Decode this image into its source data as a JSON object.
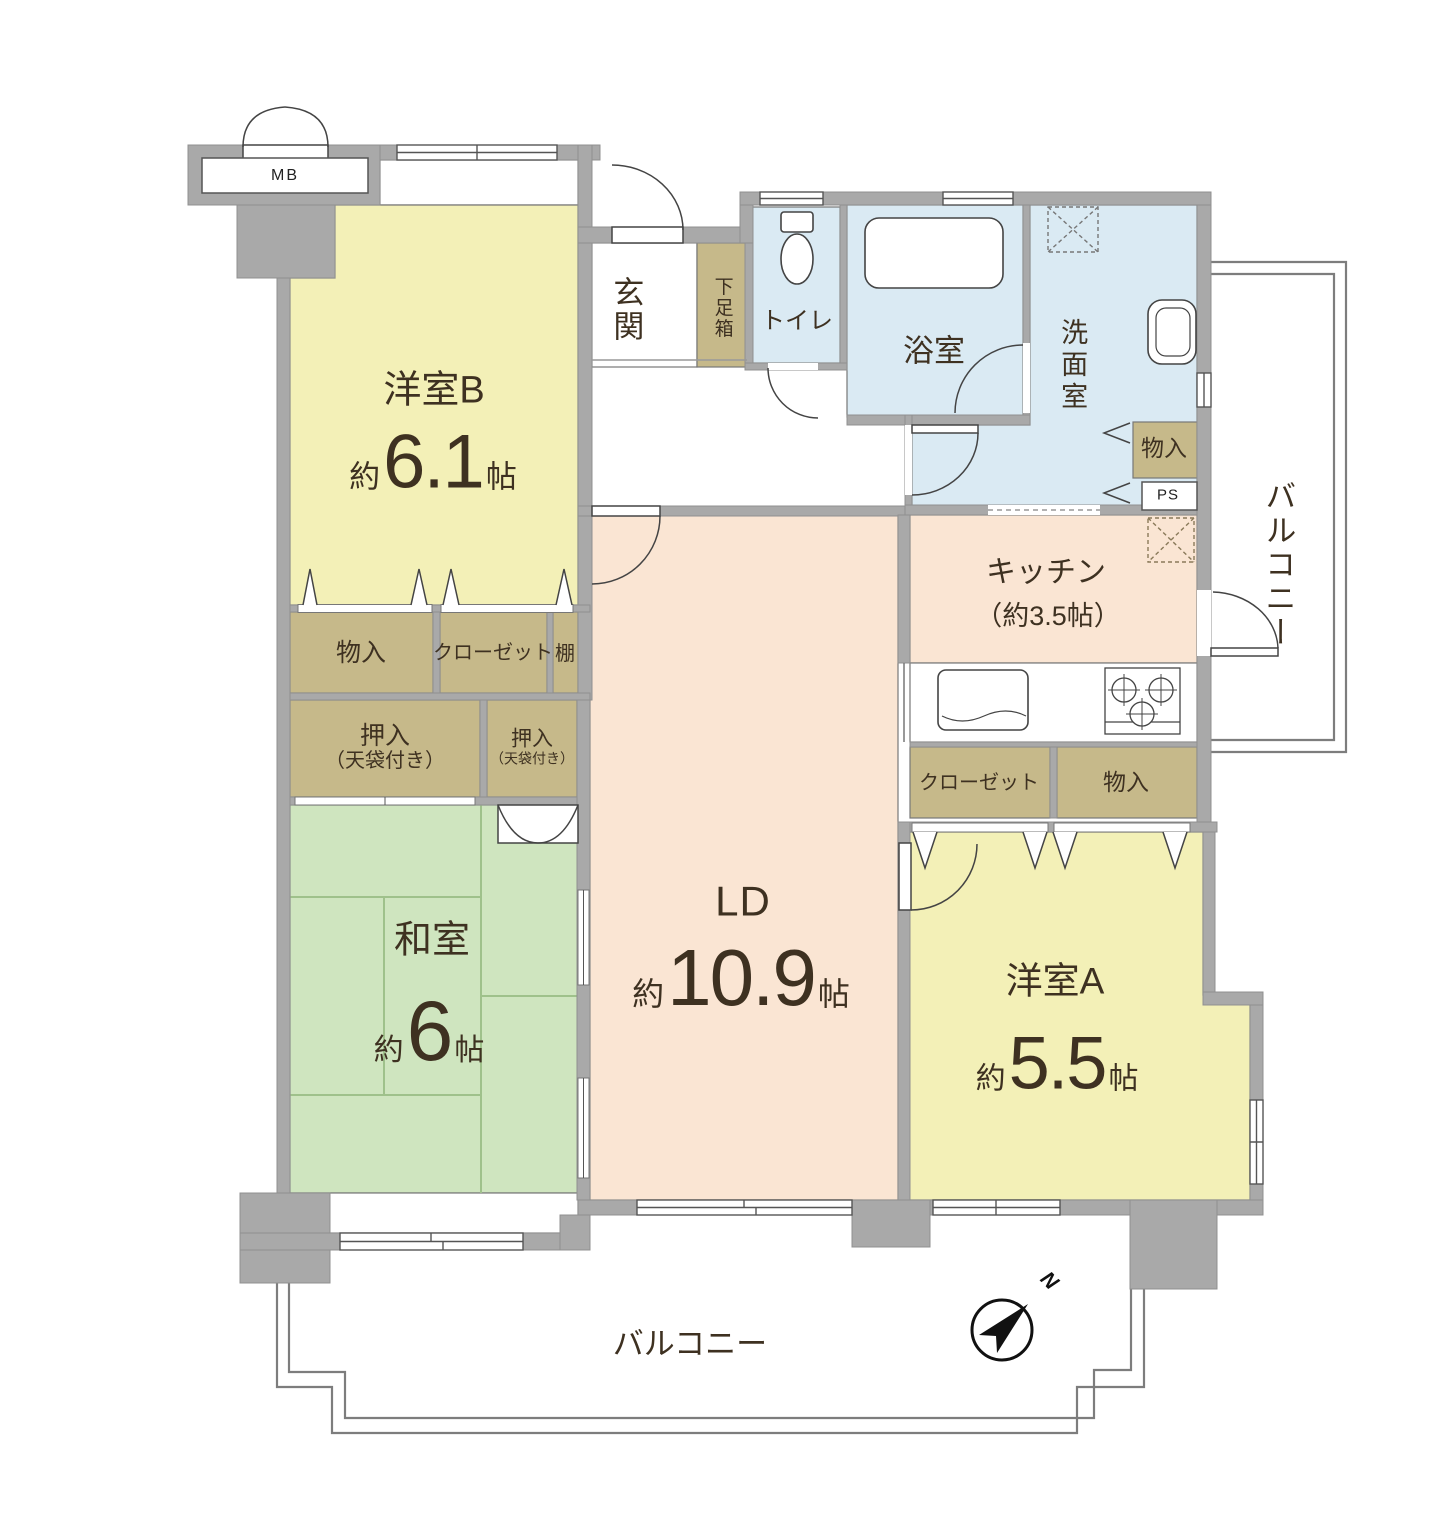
{
  "colors": {
    "wall": "#a9a9a9",
    "western_room": "#f3f0b7",
    "japanese_room": "#cfe5bf",
    "living_dining": "#fae5d3",
    "sanitary": "#daeaf3",
    "storage": "#c6b98a",
    "outline": "#555555",
    "label_text": "#3e3121"
  },
  "rooms": {
    "yoshitsu_b": {
      "name": "洋室B",
      "approx": "約",
      "value": "6.1",
      "unit": "帖"
    },
    "washitsu": {
      "name": "和室",
      "approx": "約",
      "value": "6",
      "unit": "帖"
    },
    "ld": {
      "name": "LD",
      "approx": "約",
      "value": "10.9",
      "unit": "帖"
    },
    "yoshitsu_a": {
      "name": "洋室A",
      "approx": "約",
      "value": "5.5",
      "unit": "帖"
    },
    "kitchen": {
      "name": "キッチン",
      "size_note": "（約3.5帖）"
    },
    "genkan": {
      "name": "玄関"
    },
    "getabako": {
      "name": "下足箱"
    },
    "toilet": {
      "name": "トイレ"
    },
    "bath": {
      "name": "浴室"
    },
    "senmenshitsu": {
      "name": "洗面室"
    }
  },
  "storage": {
    "monoire_washroom": "物入",
    "ps": "PS",
    "monoire_b": "物入",
    "closet_b": "クローゼット",
    "tana": "棚",
    "oshiire_large_line1": "押入",
    "oshiire_large_line2": "（天袋付き）",
    "oshiire_small_line1": "押入",
    "oshiire_small_line2": "（天袋付き）",
    "closet_a": "クローゼット",
    "monoire_a": "物入"
  },
  "balcony": {
    "right": "バルコニー",
    "bottom": "バルコニー"
  },
  "meter_box": "MB",
  "compass": {
    "north": "N"
  }
}
